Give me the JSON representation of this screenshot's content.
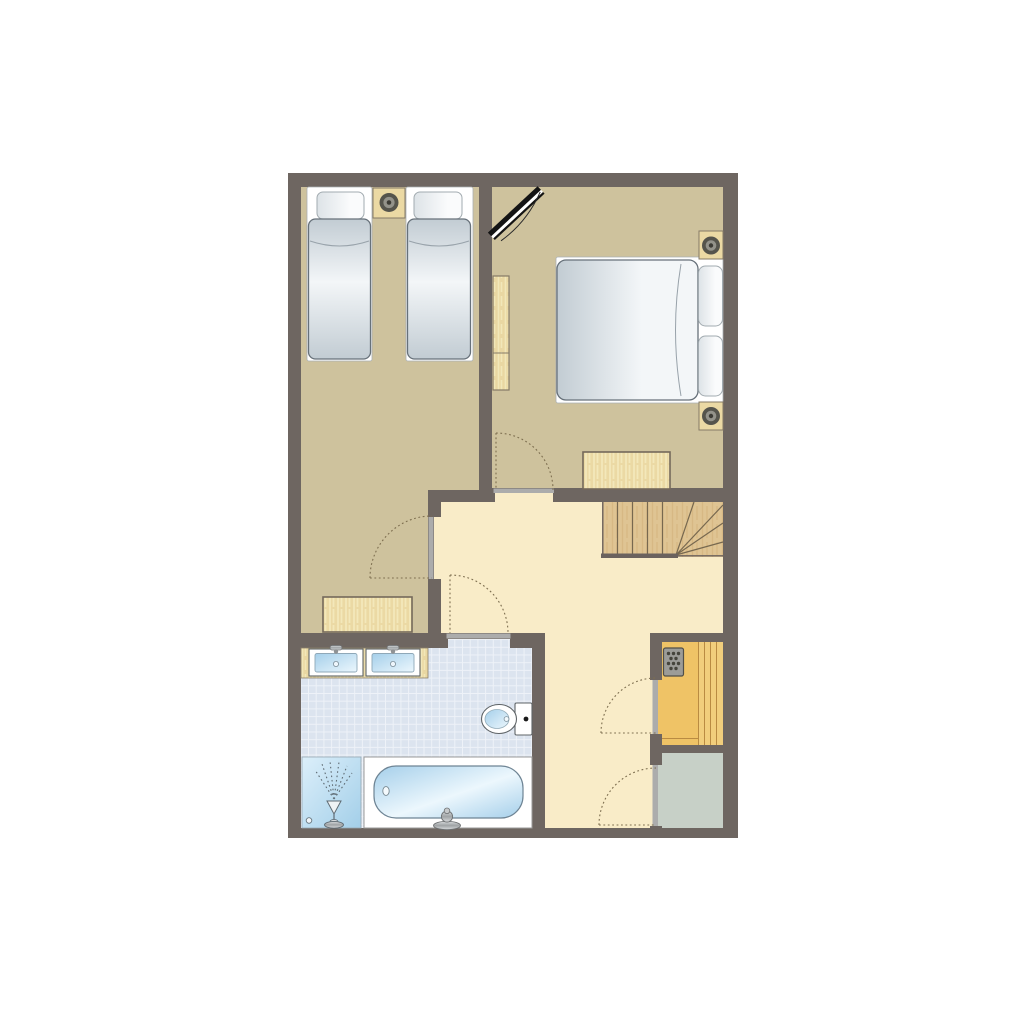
{
  "plan": {
    "type": "apartment-upper-floor",
    "rooms": [
      {
        "id": "bedroom-left",
        "kind": "twin bedroom"
      },
      {
        "id": "bedroom-right",
        "kind": "double bedroom"
      },
      {
        "id": "hall",
        "kind": "landing hall"
      },
      {
        "id": "bathroom",
        "kind": "bathroom"
      },
      {
        "id": "sauna",
        "kind": "sauna"
      },
      {
        "id": "storage",
        "kind": "storage room"
      }
    ],
    "objects": [
      "twin-bed",
      "twin-bed",
      "double-bed",
      "nightstand",
      "ceiling-lamp",
      "wardrobe",
      "dresser",
      "dresser",
      "skylight",
      "staircase-winder",
      "vanity-counter",
      "washbasin",
      "washbasin",
      "toilet",
      "bathtub",
      "shower",
      "sauna-heater",
      "sauna-bench",
      "door",
      "door",
      "door",
      "door",
      "door"
    ]
  },
  "palette": {
    "page_bg": "#ffffff",
    "wall": "#6e6661",
    "bedroom_floor": "#cec29d",
    "hall_floor": "#f9ecc8",
    "bathroom_tile": "#dce4ef",
    "tile_grid": "#eef2f8",
    "sauna_floor": "#efc366",
    "sauna_bench": "#f1ce7c",
    "bench_line": "#b98b42",
    "storage_floor": "#c7d0c7",
    "stair_wood": "#dfc493",
    "stair_grain": "#d2b07a",
    "stair_line": "#77684f",
    "stair_edge": "#6b625e",
    "wood_furniture": "#ebd9a4",
    "wood_border": "#857a66",
    "counter_wood": "#e9d7a2",
    "wood_grain_light": "#f5ecc0",
    "dresser_border": "#75695b",
    "bed_base": "#ffffff",
    "bed_base_edge": "#aab0b4",
    "mattress_edge": "#c2ccd3",
    "mattress_center": "#f3f6f8",
    "mattress_border": "#67717a",
    "pillow_fill": "#fafbfc",
    "pillow_edge": "#dde3e7",
    "pillow_border": "#a2abb0",
    "water_edge": "#a5cfea",
    "water_center": "#ecf7fd",
    "water_border": "#6e8494",
    "shower_edge": "#a3cfe9",
    "shower_center": "#dceffa",
    "shower_line": "#5f6b73",
    "door_leaf": "#acacac",
    "swing": "#7e6f50",
    "lamp_outer": "#55544c",
    "lamp_mid": "#93928a",
    "lamp_dot": "#3c3b35",
    "heater_body": "#9c9c98",
    "heater_border": "#504f49",
    "heater_dot": "#45443c",
    "metal_light": "#d8dbdd",
    "metal_dark": "#9fa3a5",
    "skylight_black": "#141414",
    "white": "#ffffff"
  }
}
